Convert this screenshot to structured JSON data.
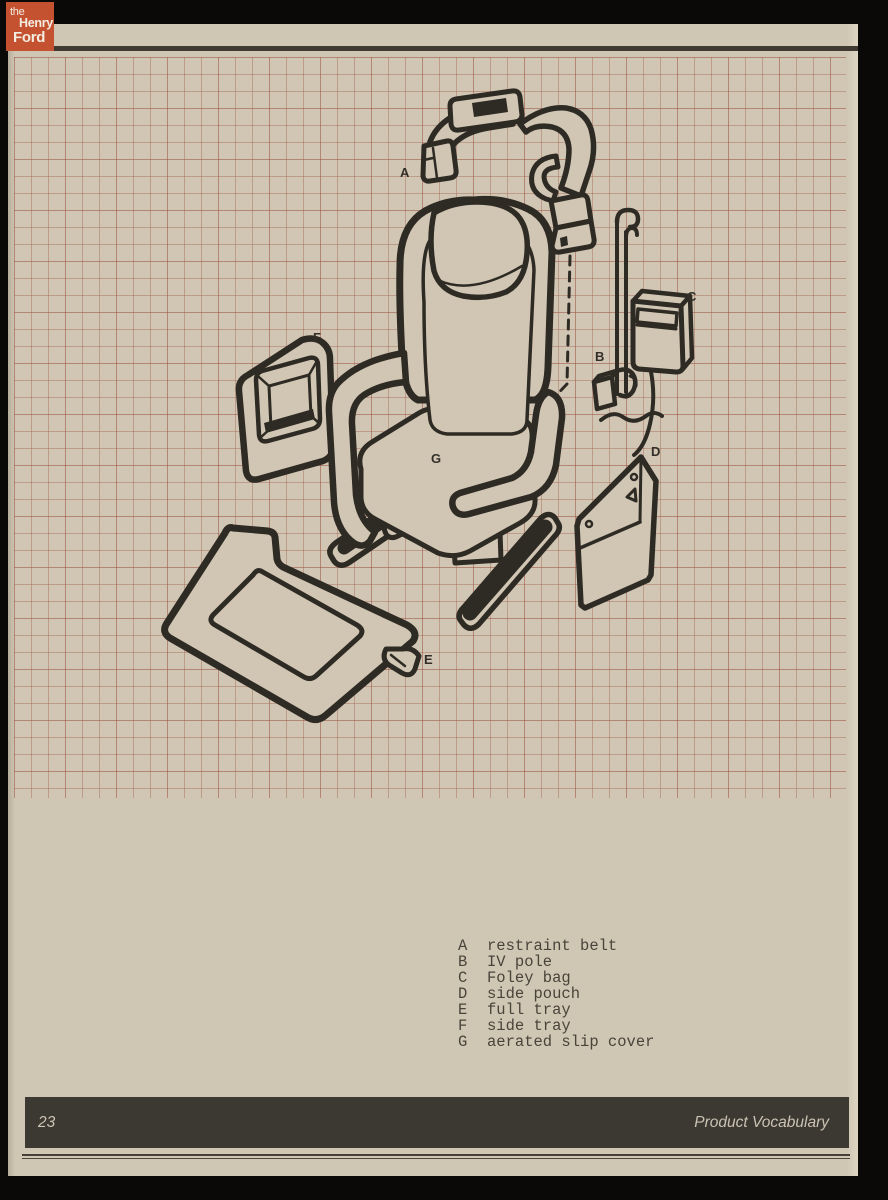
{
  "branding": {
    "logo_line1": "the",
    "logo_line2": "Henry",
    "logo_line3": "Ford"
  },
  "diagram": {
    "title": "exploded view of patient chair with accessories",
    "callouts": [
      {
        "letter": "A"
      },
      {
        "letter": "B"
      },
      {
        "letter": "C"
      },
      {
        "letter": "D"
      },
      {
        "letter": "E"
      },
      {
        "letter": "F"
      },
      {
        "letter": "G"
      }
    ]
  },
  "legend": {
    "items": [
      {
        "letter": "A",
        "term": "restraint belt"
      },
      {
        "letter": "B",
        "term": "IV pole"
      },
      {
        "letter": "C",
        "term": "Foley bag"
      },
      {
        "letter": "D",
        "term": "side pouch"
      },
      {
        "letter": "E",
        "term": "full tray"
      },
      {
        "letter": "F",
        "term": "side tray"
      },
      {
        "letter": "G",
        "term": "aerated slip cover"
      }
    ]
  },
  "footer": {
    "page_number": "23",
    "section_title": "Product Vocabulary"
  },
  "colors": {
    "paper": "#d1c6b3",
    "grid_line": "#a4614f",
    "ink": "#2e2a24",
    "footer_bar": "#3c3832",
    "logo_background": "#c4512f",
    "surround": "#0a0908"
  }
}
